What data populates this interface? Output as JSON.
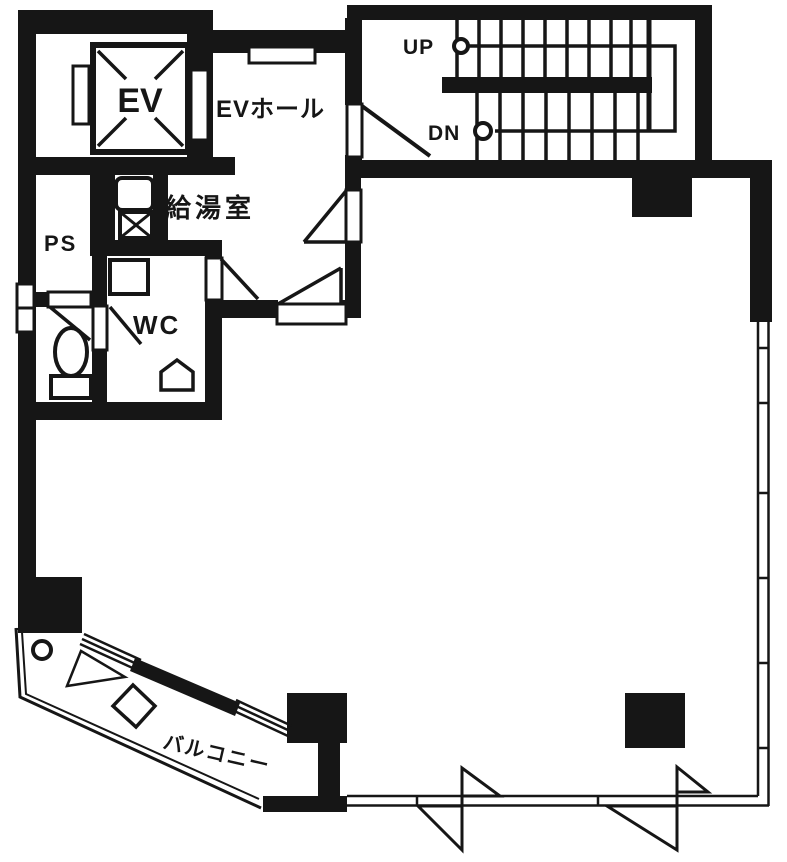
{
  "labels": {
    "elevator": "EV",
    "elevator_hall": "EVホール",
    "kitchenette": "給湯室",
    "pipe_space": "PS",
    "water_closet": "WC",
    "up": "UP",
    "down": "DN",
    "balcony": "バルコニー"
  },
  "colors": {
    "ink": "#161616",
    "paper": "#ffffff"
  }
}
